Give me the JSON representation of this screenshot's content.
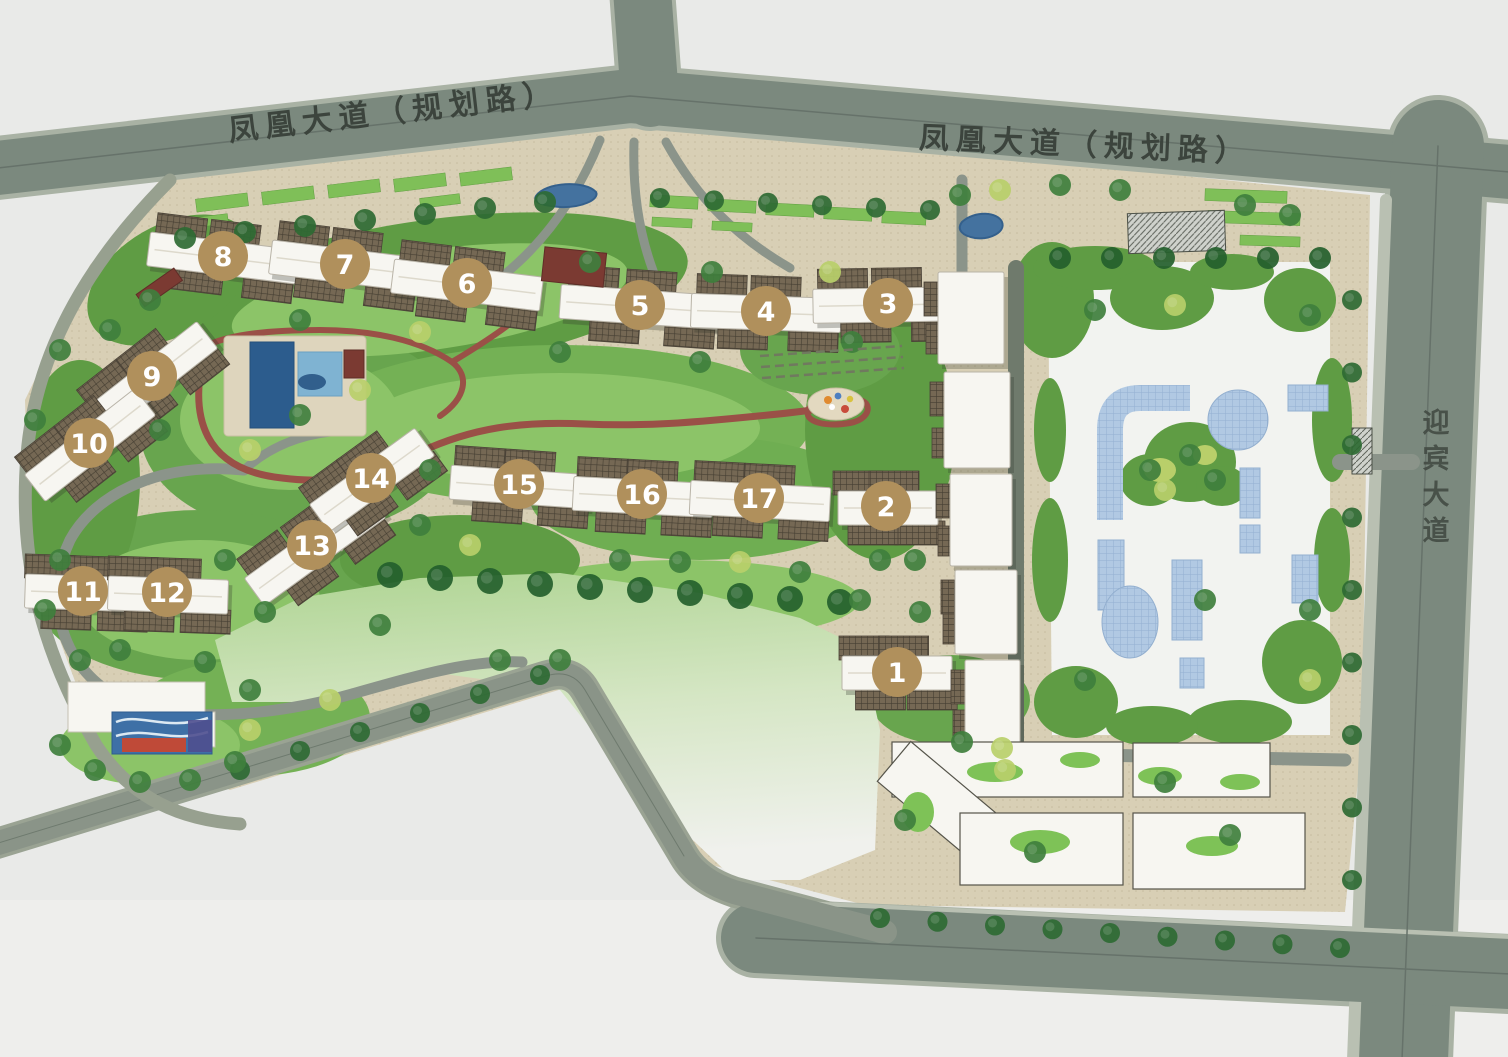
{
  "roads": {
    "phoenix_left": "凤凰大道（规划路）",
    "phoenix_right": "凤凰大道（规划路）",
    "yingbin": "迎宾大道"
  },
  "buildings": [
    {
      "label": "1"
    },
    {
      "label": "2"
    },
    {
      "label": "3"
    },
    {
      "label": "4"
    },
    {
      "label": "5"
    },
    {
      "label": "6"
    },
    {
      "label": "7"
    },
    {
      "label": "8"
    },
    {
      "label": "9"
    },
    {
      "label": "10"
    },
    {
      "label": "11"
    },
    {
      "label": "12"
    },
    {
      "label": "13"
    },
    {
      "label": "14"
    },
    {
      "label": "15"
    },
    {
      "label": "16"
    },
    {
      "label": "17"
    }
  ],
  "colors": {
    "road": "#7b897e",
    "paving": "#d8cfb5",
    "grass": "#68a54e",
    "water": "#44729f",
    "plaza_tile": "#b1c9e3",
    "building_white": "#f7f6f1",
    "garden_path_red": "#9a5047",
    "badge": "#b0905c"
  }
}
